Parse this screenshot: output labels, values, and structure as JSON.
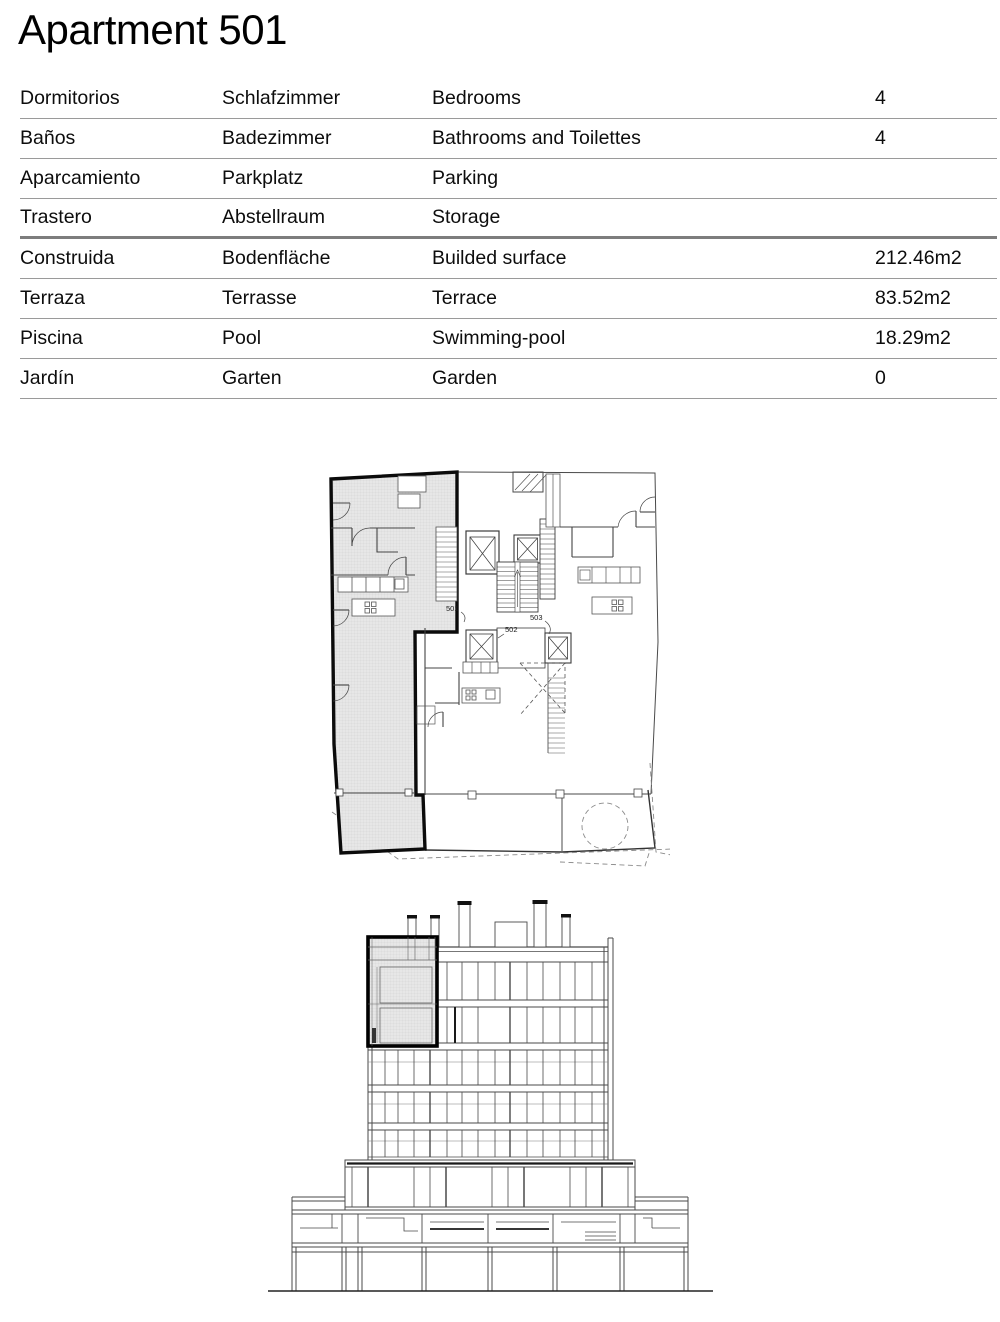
{
  "page": {
    "title": "Apartment 501"
  },
  "specs": {
    "columns": [
      "es",
      "de",
      "en",
      "value"
    ],
    "rows": [
      {
        "es": "Dormitorios",
        "de": "Schlafzimmer",
        "en": "Bedrooms",
        "value": "4"
      },
      {
        "es": "Baños",
        "de": "Badezimmer",
        "en": "Bathrooms and Toilettes",
        "value": "4"
      },
      {
        "es": "Aparcamiento",
        "de": "Parkplatz",
        "en": "Parking",
        "value": ""
      },
      {
        "es": "Trastero",
        "de": "Abstellraum",
        "en": "Storage",
        "value": ""
      },
      {
        "es": "Construida",
        "de": "Bodenfläche",
        "en": "Builded surface",
        "value": "212.46m2"
      },
      {
        "es": "Terraza",
        "de": "Terrasse",
        "en": "Terrace",
        "value": "83.52m2"
      },
      {
        "es": "Piscina",
        "de": "Pool",
        "en": "Swimming-pool",
        "value": "18.29m2"
      },
      {
        "es": "Jardín",
        "de": "Garten",
        "en": "Garden",
        "value": "0"
      }
    ],
    "thick_divider_after_row": 4
  },
  "floor_plan": {
    "highlighted_unit": "501",
    "labels": {
      "unit_501": "501",
      "unit_502": "502",
      "unit_503": "503"
    }
  },
  "elevation": {
    "highlighted_unit": "501"
  },
  "colors": {
    "text": "#0d0d0d",
    "table_divider": "#9a9a9a",
    "thick_divider": "#7d7d7d",
    "highlight_outline": "#000000",
    "hatch_fill": "#e7e7e7",
    "drawing_line": "#4a4a4a"
  }
}
